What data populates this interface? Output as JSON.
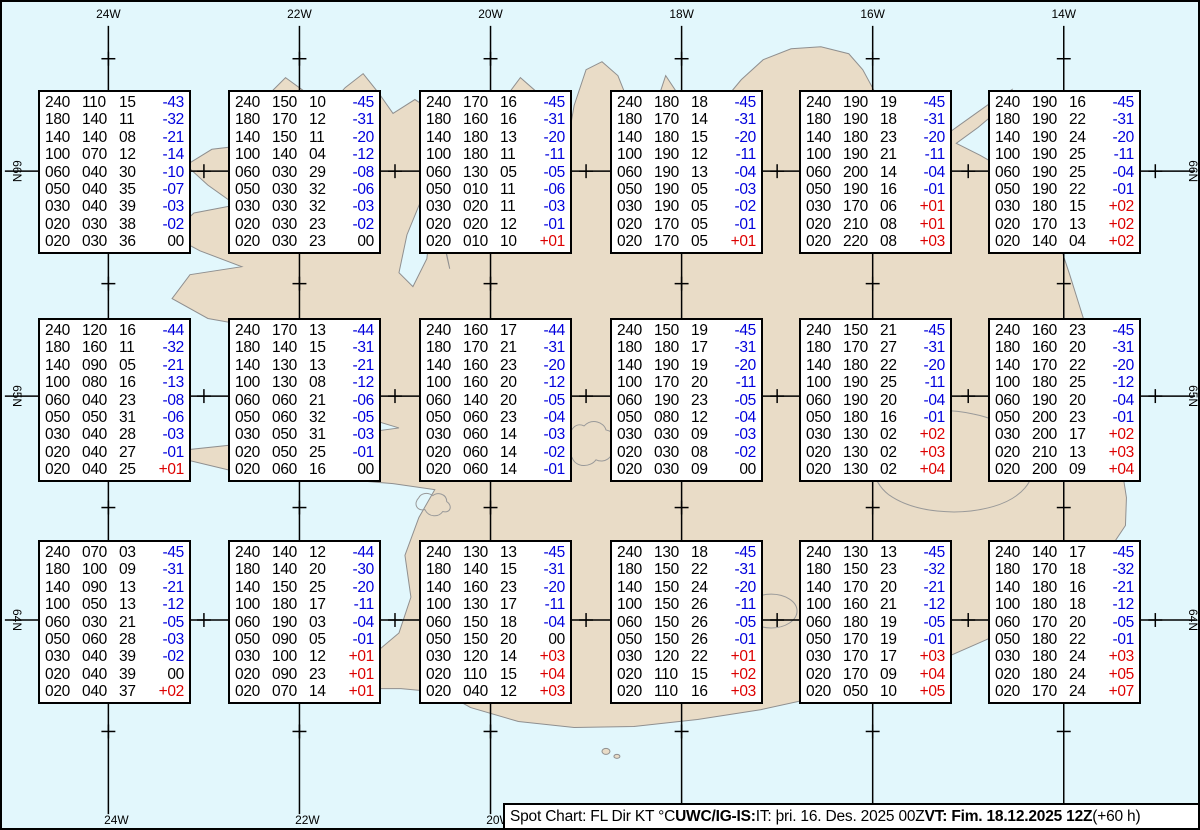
{
  "colors": {
    "ocean": "#e2f7fc",
    "land": "#e9dcc7",
    "coastline": "#8f8f8f",
    "grid": "#000000",
    "temp_negative": "#0000dd",
    "temp_positive": "#dd0000",
    "temp_zero": "#000000"
  },
  "map": {
    "lon_labels": [
      {
        "label": "24W",
        "x": 106
      },
      {
        "label": "22W",
        "x": 298
      },
      {
        "label": "20W",
        "x": 490
      },
      {
        "label": "18W",
        "x": 682
      },
      {
        "label": "16W",
        "x": 874
      },
      {
        "label": "14W",
        "x": 1066
      }
    ],
    "lat_labels": [
      {
        "label": "66N",
        "y": 170
      },
      {
        "label": "65N",
        "y": 396
      },
      {
        "label": "64N",
        "y": 621
      }
    ],
    "minor_lon_xs": [
      202,
      394,
      586,
      778,
      970,
      1158
    ],
    "minor_lat_ys": [
      57,
      283,
      508,
      733
    ]
  },
  "chart_data": {
    "type": "table",
    "title": "Spot Chart: FL Dir KT °C",
    "columns": [
      "FL",
      "Dir",
      "KT",
      "°C"
    ],
    "grid": {
      "rows": 3,
      "cols": 6
    },
    "boxes": [
      {
        "row": 1,
        "col": 1,
        "values": [
          [
            "240",
            "110",
            "15",
            "-43"
          ],
          [
            "180",
            "140",
            "11",
            "-32"
          ],
          [
            "140",
            "140",
            "08",
            "-21"
          ],
          [
            "100",
            "070",
            "12",
            "-14"
          ],
          [
            "060",
            "040",
            "30",
            "-10"
          ],
          [
            "050",
            "040",
            "35",
            "-07"
          ],
          [
            "030",
            "040",
            "39",
            "-03"
          ],
          [
            "020",
            "030",
            "38",
            "-02"
          ],
          [
            "020",
            "030",
            "36",
            "00"
          ]
        ]
      },
      {
        "row": 1,
        "col": 2,
        "values": [
          [
            "240",
            "150",
            "10",
            "-45"
          ],
          [
            "180",
            "170",
            "12",
            "-31"
          ],
          [
            "140",
            "150",
            "11",
            "-20"
          ],
          [
            "100",
            "140",
            "04",
            "-12"
          ],
          [
            "060",
            "030",
            "29",
            "-08"
          ],
          [
            "050",
            "030",
            "32",
            "-06"
          ],
          [
            "030",
            "030",
            "32",
            "-03"
          ],
          [
            "020",
            "030",
            "23",
            "-02"
          ],
          [
            "020",
            "030",
            "23",
            "00"
          ]
        ]
      },
      {
        "row": 1,
        "col": 3,
        "values": [
          [
            "240",
            "170",
            "16",
            "-45"
          ],
          [
            "180",
            "160",
            "16",
            "-31"
          ],
          [
            "140",
            "180",
            "13",
            "-20"
          ],
          [
            "100",
            "180",
            "11",
            "-11"
          ],
          [
            "060",
            "130",
            "05",
            "-05"
          ],
          [
            "050",
            "010",
            "11",
            "-06"
          ],
          [
            "030",
            "020",
            "11",
            "-03"
          ],
          [
            "020",
            "020",
            "12",
            "-01"
          ],
          [
            "020",
            "010",
            "10",
            "+01"
          ]
        ]
      },
      {
        "row": 1,
        "col": 4,
        "values": [
          [
            "240",
            "180",
            "18",
            "-45"
          ],
          [
            "180",
            "170",
            "14",
            "-31"
          ],
          [
            "140",
            "180",
            "15",
            "-20"
          ],
          [
            "100",
            "190",
            "12",
            "-11"
          ],
          [
            "060",
            "190",
            "13",
            "-04"
          ],
          [
            "050",
            "190",
            "05",
            "-03"
          ],
          [
            "030",
            "190",
            "05",
            "-02"
          ],
          [
            "020",
            "170",
            "05",
            "-01"
          ],
          [
            "020",
            "170",
            "05",
            "+01"
          ]
        ]
      },
      {
        "row": 1,
        "col": 5,
        "values": [
          [
            "240",
            "190",
            "19",
            "-45"
          ],
          [
            "180",
            "190",
            "18",
            "-31"
          ],
          [
            "140",
            "180",
            "23",
            "-20"
          ],
          [
            "100",
            "190",
            "21",
            "-11"
          ],
          [
            "060",
            "200",
            "14",
            "-04"
          ],
          [
            "050",
            "190",
            "16",
            "-01"
          ],
          [
            "030",
            "170",
            "06",
            "+01"
          ],
          [
            "020",
            "210",
            "08",
            "+01"
          ],
          [
            "020",
            "220",
            "08",
            "+03"
          ]
        ]
      },
      {
        "row": 1,
        "col": 6,
        "values": [
          [
            "240",
            "190",
            "16",
            "-45"
          ],
          [
            "180",
            "190",
            "22",
            "-31"
          ],
          [
            "140",
            "190",
            "24",
            "-20"
          ],
          [
            "100",
            "190",
            "25",
            "-11"
          ],
          [
            "060",
            "190",
            "25",
            "-04"
          ],
          [
            "050",
            "190",
            "22",
            "-01"
          ],
          [
            "030",
            "180",
            "15",
            "+02"
          ],
          [
            "020",
            "170",
            "13",
            "+02"
          ],
          [
            "020",
            "140",
            "04",
            "+02"
          ]
        ]
      },
      {
        "row": 2,
        "col": 1,
        "values": [
          [
            "240",
            "120",
            "16",
            "-44"
          ],
          [
            "180",
            "160",
            "11",
            "-32"
          ],
          [
            "140",
            "090",
            "05",
            "-21"
          ],
          [
            "100",
            "080",
            "16",
            "-13"
          ],
          [
            "060",
            "040",
            "23",
            "-08"
          ],
          [
            "050",
            "050",
            "31",
            "-06"
          ],
          [
            "030",
            "040",
            "28",
            "-03"
          ],
          [
            "020",
            "040",
            "27",
            "-01"
          ],
          [
            "020",
            "040",
            "25",
            "+01"
          ]
        ]
      },
      {
        "row": 2,
        "col": 2,
        "values": [
          [
            "240",
            "170",
            "13",
            "-44"
          ],
          [
            "180",
            "140",
            "15",
            "-31"
          ],
          [
            "140",
            "130",
            "13",
            "-21"
          ],
          [
            "100",
            "130",
            "08",
            "-12"
          ],
          [
            "060",
            "060",
            "21",
            "-06"
          ],
          [
            "050",
            "060",
            "32",
            "-05"
          ],
          [
            "030",
            "050",
            "31",
            "-03"
          ],
          [
            "020",
            "050",
            "25",
            "-01"
          ],
          [
            "020",
            "060",
            "16",
            "00"
          ]
        ]
      },
      {
        "row": 2,
        "col": 3,
        "values": [
          [
            "240",
            "160",
            "17",
            "-44"
          ],
          [
            "180",
            "170",
            "21",
            "-31"
          ],
          [
            "140",
            "160",
            "23",
            "-20"
          ],
          [
            "100",
            "160",
            "20",
            "-12"
          ],
          [
            "060",
            "140",
            "20",
            "-05"
          ],
          [
            "050",
            "060",
            "23",
            "-04"
          ],
          [
            "030",
            "060",
            "14",
            "-03"
          ],
          [
            "020",
            "060",
            "14",
            "-02"
          ],
          [
            "020",
            "060",
            "14",
            "-01"
          ]
        ]
      },
      {
        "row": 2,
        "col": 4,
        "values": [
          [
            "240",
            "150",
            "19",
            "-45"
          ],
          [
            "180",
            "180",
            "17",
            "-31"
          ],
          [
            "140",
            "190",
            "19",
            "-20"
          ],
          [
            "100",
            "170",
            "20",
            "-11"
          ],
          [
            "060",
            "190",
            "23",
            "-05"
          ],
          [
            "050",
            "080",
            "12",
            "-04"
          ],
          [
            "030",
            "030",
            "09",
            "-03"
          ],
          [
            "020",
            "030",
            "08",
            "-02"
          ],
          [
            "020",
            "030",
            "09",
            "00"
          ]
        ]
      },
      {
        "row": 2,
        "col": 5,
        "values": [
          [
            "240",
            "150",
            "21",
            "-45"
          ],
          [
            "180",
            "170",
            "27",
            "-31"
          ],
          [
            "140",
            "180",
            "22",
            "-20"
          ],
          [
            "100",
            "190",
            "25",
            "-11"
          ],
          [
            "060",
            "190",
            "20",
            "-04"
          ],
          [
            "050",
            "180",
            "16",
            "-01"
          ],
          [
            "030",
            "130",
            "02",
            "+02"
          ],
          [
            "020",
            "130",
            "02",
            "+03"
          ],
          [
            "020",
            "130",
            "02",
            "+04"
          ]
        ]
      },
      {
        "row": 2,
        "col": 6,
        "values": [
          [
            "240",
            "160",
            "23",
            "-45"
          ],
          [
            "180",
            "160",
            "20",
            "-31"
          ],
          [
            "140",
            "170",
            "22",
            "-20"
          ],
          [
            "100",
            "180",
            "25",
            "-12"
          ],
          [
            "060",
            "190",
            "20",
            "-04"
          ],
          [
            "050",
            "200",
            "23",
            "-01"
          ],
          [
            "030",
            "200",
            "17",
            "+02"
          ],
          [
            "020",
            "210",
            "13",
            "+03"
          ],
          [
            "020",
            "200",
            "09",
            "+04"
          ]
        ]
      },
      {
        "row": 3,
        "col": 1,
        "values": [
          [
            "240",
            "070",
            "03",
            "-45"
          ],
          [
            "180",
            "100",
            "09",
            "-31"
          ],
          [
            "140",
            "090",
            "13",
            "-21"
          ],
          [
            "100",
            "050",
            "13",
            "-12"
          ],
          [
            "060",
            "030",
            "21",
            "-05"
          ],
          [
            "050",
            "060",
            "28",
            "-03"
          ],
          [
            "030",
            "040",
            "39",
            "-02"
          ],
          [
            "020",
            "040",
            "39",
            "00"
          ],
          [
            "020",
            "040",
            "37",
            "+02"
          ]
        ]
      },
      {
        "row": 3,
        "col": 2,
        "values": [
          [
            "240",
            "140",
            "12",
            "-44"
          ],
          [
            "180",
            "140",
            "20",
            "-30"
          ],
          [
            "140",
            "150",
            "25",
            "-20"
          ],
          [
            "100",
            "180",
            "17",
            "-11"
          ],
          [
            "060",
            "190",
            "03",
            "-04"
          ],
          [
            "050",
            "090",
            "05",
            "-01"
          ],
          [
            "030",
            "100",
            "12",
            "+01"
          ],
          [
            "020",
            "090",
            "23",
            "+01"
          ],
          [
            "020",
            "070",
            "14",
            "+01"
          ]
        ]
      },
      {
        "row": 3,
        "col": 3,
        "values": [
          [
            "240",
            "130",
            "13",
            "-45"
          ],
          [
            "180",
            "140",
            "15",
            "-31"
          ],
          [
            "140",
            "160",
            "23",
            "-20"
          ],
          [
            "100",
            "130",
            "17",
            "-11"
          ],
          [
            "060",
            "150",
            "18",
            "-04"
          ],
          [
            "050",
            "150",
            "20",
            "00"
          ],
          [
            "030",
            "120",
            "14",
            "+03"
          ],
          [
            "020",
            "110",
            "15",
            "+04"
          ],
          [
            "020",
            "040",
            "12",
            "+03"
          ]
        ]
      },
      {
        "row": 3,
        "col": 4,
        "values": [
          [
            "240",
            "130",
            "18",
            "-45"
          ],
          [
            "180",
            "150",
            "22",
            "-31"
          ],
          [
            "140",
            "150",
            "24",
            "-20"
          ],
          [
            "100",
            "150",
            "26",
            "-11"
          ],
          [
            "060",
            "150",
            "26",
            "-05"
          ],
          [
            "050",
            "150",
            "26",
            "-01"
          ],
          [
            "030",
            "120",
            "22",
            "+01"
          ],
          [
            "020",
            "110",
            "15",
            "+02"
          ],
          [
            "020",
            "110",
            "16",
            "+03"
          ]
        ]
      },
      {
        "row": 3,
        "col": 5,
        "values": [
          [
            "240",
            "130",
            "13",
            "-45"
          ],
          [
            "180",
            "150",
            "23",
            "-32"
          ],
          [
            "140",
            "170",
            "20",
            "-21"
          ],
          [
            "100",
            "160",
            "21",
            "-12"
          ],
          [
            "060",
            "180",
            "19",
            "-05"
          ],
          [
            "050",
            "170",
            "19",
            "-01"
          ],
          [
            "030",
            "170",
            "17",
            "+03"
          ],
          [
            "020",
            "170",
            "09",
            "+04"
          ],
          [
            "020",
            "050",
            "10",
            "+05"
          ]
        ]
      },
      {
        "row": 3,
        "col": 6,
        "values": [
          [
            "240",
            "140",
            "17",
            "-45"
          ],
          [
            "180",
            "170",
            "18",
            "-32"
          ],
          [
            "140",
            "180",
            "16",
            "-21"
          ],
          [
            "100",
            "180",
            "18",
            "-12"
          ],
          [
            "060",
            "170",
            "20",
            "-05"
          ],
          [
            "050",
            "180",
            "22",
            "-01"
          ],
          [
            "030",
            "180",
            "24",
            "+03"
          ],
          [
            "020",
            "180",
            "24",
            "+05"
          ],
          [
            "020",
            "170",
            "24",
            "+07"
          ]
        ]
      }
    ]
  },
  "caption": {
    "segments": [
      {
        "text": "Spot Chart: FL Dir KT °C ",
        "bold": false
      },
      {
        "text": "UWC/IG-IS:",
        "bold": true
      },
      {
        "text": " IT: þri. 16. Des. 2025 00Z ",
        "bold": false
      },
      {
        "text": "VT: Fim. 18.12.2025 12Z",
        "bold": true
      },
      {
        "text": " (+60 h)",
        "bold": false
      }
    ]
  }
}
